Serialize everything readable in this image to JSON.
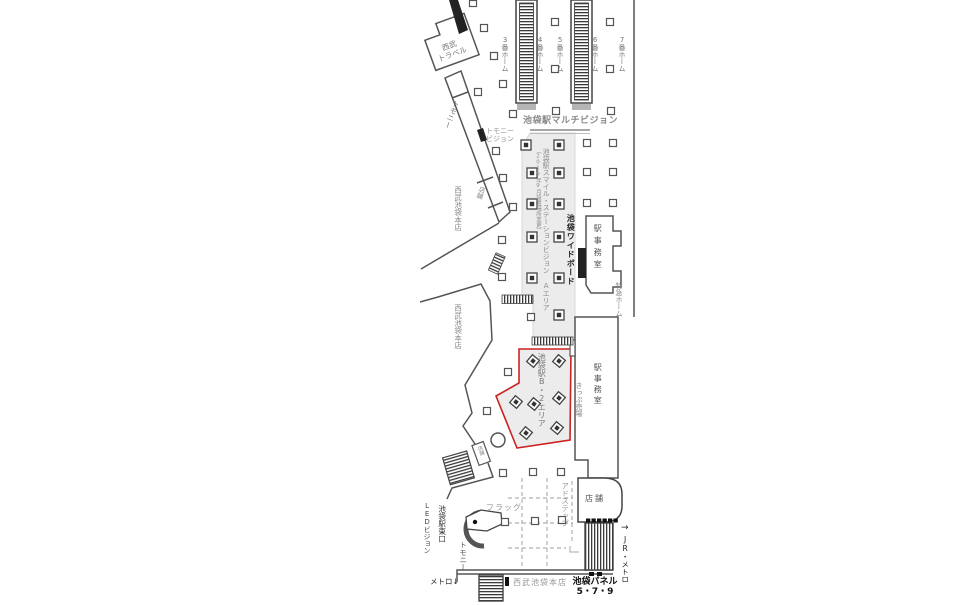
{
  "labels": {
    "seibu_travel_line1": "西武",
    "seibu_travel_line2": "トラベル",
    "tomony_upper": "トモニー",
    "tomony_vision_line1": "トモニー",
    "tomony_vision_line2": "ビジョン",
    "multivision": "池袋駅マルチビジョン",
    "platform_3": "3番ホーム",
    "platform_4": "4番ホーム",
    "platform_5": "5番ホーム",
    "platform_6": "6番ホーム",
    "platform_7": "7番ホーム",
    "smile_vision": "池袋駅スマイル・ステーションビジョン Aエリア",
    "smile_vision_note": "（2019年9月設置場所変更）",
    "wide_board": "池袋ワイドボード",
    "office_upper": "駅事務室",
    "limited_express": "特急ホーム",
    "seibu_store_upper": "西武池袋本店",
    "store_corridor": "店舗",
    "seibu_store_mid": "西武池袋本店",
    "b2_area": "池袋駅B・2エリア",
    "office_lower": "駅事務室",
    "ticket_office": "きっぷ売場",
    "ad_step": "アドステップ",
    "store_lower": "店舗",
    "store_small": "店舗",
    "jr_metro_arrow": "→",
    "jr_metro": "JR・メトロ",
    "flag": "フラッグ",
    "led_vision": "LEDビジョン",
    "east_exit": "池袋駅東口",
    "tomony_lower": "トモニー",
    "metro_down": "メトロ↓",
    "seibu_store_bottom": "西武池袋本店",
    "panel_line1": "池袋パネル",
    "panel_line2": "5・7・9"
  },
  "colors": {
    "highlight_border": "#cc2222",
    "area_fill": "#ececec",
    "wall": "#555555",
    "label_gray": "#808080",
    "label_dark": "#222222"
  }
}
